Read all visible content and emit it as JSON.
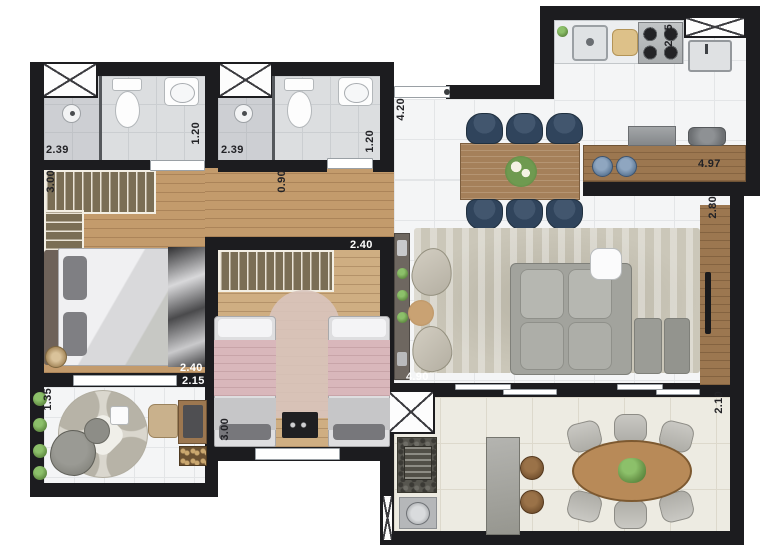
{
  "plan_title": "apartment-floor-plan",
  "dims": {
    "bath1_width": "2.39",
    "bath1_depth": "1.20",
    "bath2_width": "2.39",
    "bath2_depth": "1.20",
    "corridor_width": "0.90",
    "hall_length": "4.20",
    "kitchen_depth": "2.95",
    "kitchen_length": "4.97",
    "living_depth": "2.80",
    "living_length": "4.90",
    "master_width": "3.00",
    "master_length": "2.40",
    "bed2_length": "2.40",
    "bed2_width": "3.00",
    "office_width": "1.35",
    "office_length": "2.15",
    "balcony_depth": "2.10"
  },
  "colors": {
    "wall": "#1c1c1f",
    "tile_white": "#f4f5f6",
    "tile_grout": "#e3e5e7",
    "tile_gray": "#dcdee0",
    "tile_gray_grout": "#cbced1",
    "wood": "#c39b6c",
    "wood_light": "#cfae82",
    "counter_wood": "#9c7750",
    "closet": "#7a6e55",
    "balcony_tile": "#edebe2",
    "rug": "#cbc7b9",
    "navy": "#30445c",
    "pink": "#d9b7bb",
    "sofa": "#a2a39d",
    "green": "#6d9a4d",
    "white_fixture": "#fdfdfd",
    "label_dark": "#222226",
    "label_light": "#ffffff"
  }
}
